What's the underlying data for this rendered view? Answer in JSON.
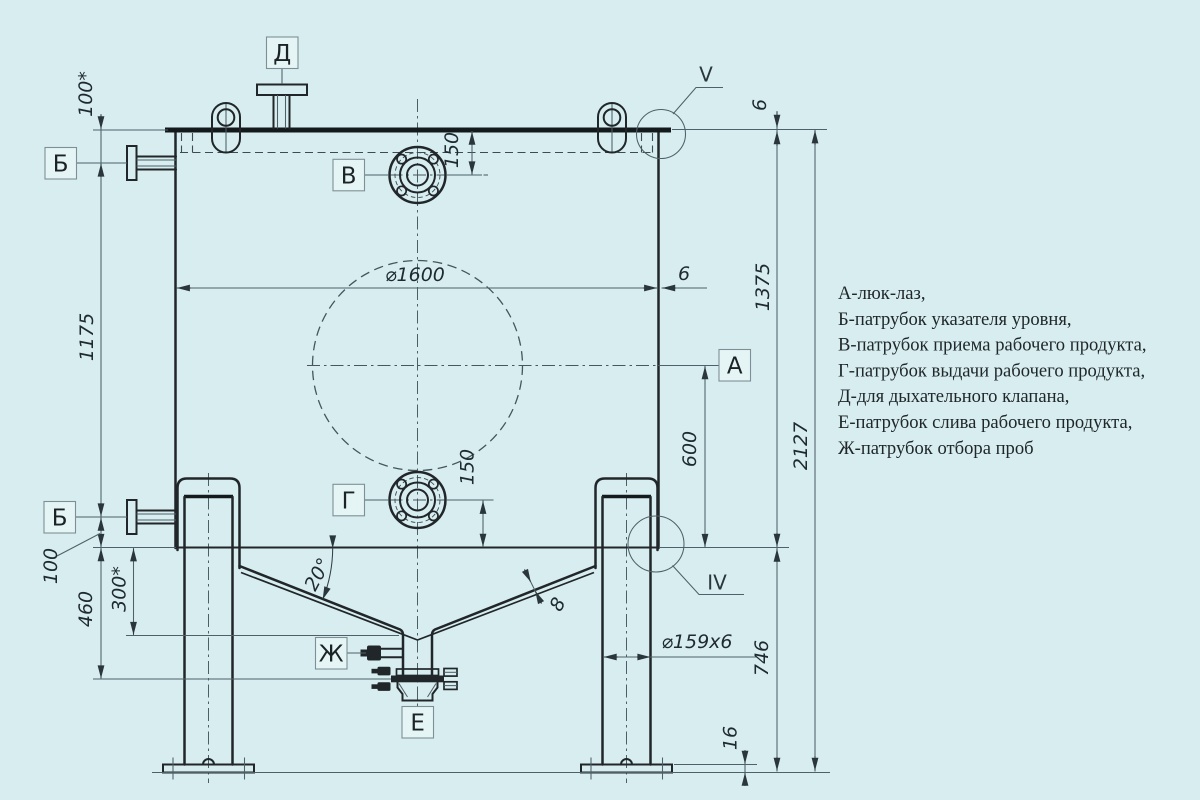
{
  "drawing": {
    "title_hint": "tank technical drawing",
    "colors": {
      "background": "#d7edef",
      "ink": "#20262a",
      "thin_line": "#4e6168"
    },
    "labels": {
      "a": "А",
      "b": "Б",
      "v": "В",
      "g": "Г",
      "d": "Д",
      "e": "Е",
      "zh": "Ж"
    },
    "views": {
      "v": "V",
      "iv": "IV"
    },
    "dims": {
      "d100_star": "100*",
      "d1175": "1175",
      "d100": "100",
      "d460": "460",
      "d300_star": "300*",
      "d150_top": "150",
      "d150_bottom": "150",
      "d1600": "⌀1600",
      "d6_wall": "6",
      "d6_top": "6",
      "d600": "600",
      "d1375": "1375",
      "d2127": "2127",
      "d746": "746",
      "d16": "16",
      "d159": "⌀159х6",
      "d20": "20°",
      "d8": "8"
    },
    "legend": {
      "items": [
        "А-люк-лаз,",
        "Б-патрубок указателя уровня,",
        "В-патрубок приема рабочего продукта,",
        "Г-патрубок выдачи рабочего продукта,",
        "Д-для дыхательного клапана,",
        "Е-патрубок слива рабочего продукта,",
        "Ж-патрубок отбора проб"
      ]
    }
  }
}
